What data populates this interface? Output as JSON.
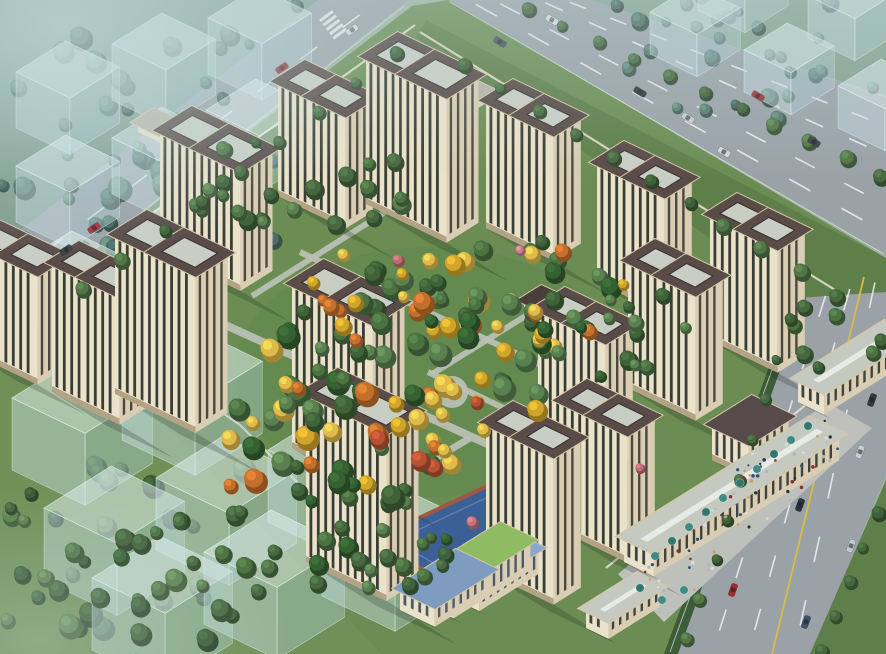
{
  "scene_label": "aerial-residential-masterplan-render",
  "projection": {
    "EU": [
      0.8,
      -0.5
    ],
    "EV": [
      0.87,
      0.42
    ],
    "twin_offset": 0.85
  },
  "colors": {
    "base": "#9db3a0",
    "zoneTL": "#7e9c8c",
    "zoneTR": "#85a28f",
    "siteGrass": "#6b8d53",
    "gardenGrass": "#648a4f",
    "fieldGrass": "#6f9157",
    "asphalt": "#9aa2a8",
    "laneWhite": "#eef1f2",
    "laneYellow": "#d9bc40",
    "edgeLine": "#dfe3e4",
    "verge": "#5f7f4a",
    "hedge": "#3d5c38",
    "pavement": "#bdc0bb",
    "path": "#bcc1b7",
    "facade": "#eae2ca",
    "facadeSide": "#d9ceb3",
    "stripSW": "#3a3d34",
    "stripSE": "#4c483d",
    "baseBand": "#b3a384",
    "roofDark": "#594b48",
    "roofPanel": "#c9cec5",
    "panelEdge": "#37322d",
    "parapet": "#d3c6a6",
    "cubeTop": "rgba(224,239,241,0.55)",
    "cubeSW": "rgba(198,223,227,0.46)",
    "cubeSE": "rgba(178,207,213,0.40)",
    "cubeEdge": "rgba(244,252,252,0.55)",
    "kgRoof": "#7d9cc0",
    "kgRoof2": "#89a8c9",
    "lawn": "#8fbc62",
    "playBlue": "#3c5f95",
    "playInner": "#5b7fb4",
    "track": "#a05844",
    "star": "#e9cb4e",
    "comRoof": "#c6c9c0",
    "comSky": "#e8eae6",
    "awning": "#3d8b82",
    "awning2": "#2f776f",
    "wall": "#e4ddc8",
    "shadow": "rgba(22,32,26,0.22)",
    "hazeTL": "rgba(198,222,225,0.60)",
    "hazeTop": "rgba(192,216,219,0.32)",
    "hazeBL": "rgba(186,210,204,0.34)"
  },
  "palettes": {
    "gardenMix": [
      "#3f6239",
      "#4c7242",
      "#5a8050",
      "#356031",
      "#4c7242",
      "#d1a52c",
      "#5a8050",
      "#e0ba4a",
      "#3f6239",
      "#c4702d"
    ],
    "gardenGreens": [
      "#3f6239",
      "#4c7242",
      "#5a8050",
      "#356031",
      "#47683f"
    ],
    "mutedTL": [
      "#4d6e63",
      "#577a6c",
      "#43635a",
      "#5e8272"
    ],
    "fieldBL": [
      "#42633c",
      "#507347",
      "#3a5a36",
      "#5d8150"
    ],
    "roadRow": [
      "#47683f",
      "#527547",
      "#3e5f38"
    ],
    "yellowAccent": [
      "#d1a52c",
      "#e0ba4a",
      "#c4702d",
      "#b55233"
    ],
    "people": [
      "#2c3136",
      "#863030",
      "#d8dade",
      "#36507a",
      "#b0b6ba",
      "#caa06a"
    ]
  },
  "zones": {
    "topLeft": [
      [
        0,
        0
      ],
      [
        322,
        0
      ],
      [
        0,
        250
      ]
    ],
    "topRight": [
      [
        590,
        0
      ],
      [
        886,
        0
      ],
      [
        886,
        96
      ]
    ],
    "site": [
      [
        412,
        6
      ],
      [
        448,
        0
      ],
      [
        886,
        258
      ],
      [
        886,
        300
      ],
      [
        806,
        654
      ],
      [
        380,
        654
      ],
      [
        40,
        292
      ]
    ],
    "field": [
      [
        0,
        250
      ],
      [
        0,
        654
      ],
      [
        380,
        654
      ],
      [
        40,
        292
      ]
    ],
    "gardenTint": {
      "cx": 430,
      "cy": 372,
      "rx": 195,
      "ry": 125
    }
  },
  "roads": {
    "highway": [
      [
        448,
        0
      ],
      [
        590,
        0
      ],
      [
        886,
        98
      ],
      [
        886,
        255
      ]
    ],
    "left": [
      [
        318,
        0
      ],
      [
        408,
        0
      ],
      [
        45,
        288
      ],
      [
        0,
        288
      ],
      [
        0,
        246
      ]
    ],
    "right": [
      [
        886,
        255
      ],
      [
        886,
        475
      ],
      [
        812,
        654
      ],
      [
        668,
        654
      ],
      [
        800,
        295
      ]
    ],
    "neVerge": [
      [
        426,
        20
      ],
      [
        886,
        258
      ],
      [
        886,
        292
      ],
      [
        798,
        298
      ],
      [
        416,
        38
      ]
    ],
    "rightHedge": [
      [
        796,
        293
      ],
      [
        664,
        654
      ],
      [
        678,
        654
      ],
      [
        806,
        298
      ]
    ],
    "rightFarVerge": [
      [
        886,
        480
      ],
      [
        886,
        654
      ],
      [
        810,
        654
      ]
    ],
    "dashes": [
      {
        "p1": [
          564,
          0
        ],
        "p2": [
          886,
          126
        ],
        "n": 8
      },
      {
        "p1": [
          539,
          0
        ],
        "p2": [
          886,
          155
        ],
        "n": 8
      },
      {
        "p1": [
          493,
          0
        ],
        "p2": [
          886,
          205
        ],
        "n": 8
      },
      {
        "p1": [
          468,
          0
        ],
        "p2": [
          886,
          233
        ],
        "n": 8
      },
      {
        "p1": [
          828,
          288
        ],
        "p2": [
          712,
          654
        ],
        "n": 7
      },
      {
        "p1": [
          852,
          281
        ],
        "p2": [
          748,
          654
        ],
        "n": 7
      },
      {
        "p1": [
          877,
          273
        ],
        "p2": [
          794,
          654
        ],
        "n": 6
      },
      {
        "p1": [
          366,
          10
        ],
        "p2": [
          26,
          266
        ],
        "n": 8
      }
    ],
    "solidWhite": [
      {
        "p1": [
          450,
          2
        ],
        "p2": [
          884,
          254
        ]
      },
      {
        "p1": [
          798,
          298
        ],
        "p2": [
          670,
          652
        ]
      },
      {
        "p1": [
          404,
          6
        ],
        "p2": [
          48,
          286
        ]
      }
    ],
    "yellowLine": {
      "p1": [
        864,
        277
      ],
      "p2": [
        772,
        654
      ]
    },
    "zebra": {
      "cx": 334,
      "cy": 26,
      "rot": -37,
      "bars": 5
    }
  },
  "walls": [
    {
      "pts": [
        [
          415,
          25
        ],
        [
          45,
          290
        ]
      ]
    },
    {
      "pts": [
        [
          45,
          290
        ],
        [
          240,
          425
        ],
        [
          430,
          615
        ]
      ]
    },
    {
      "pts": [
        [
          420,
          32
        ],
        [
          848,
          298
        ]
      ]
    },
    {
      "pts": [
        [
          606,
          568
        ],
        [
          846,
          372
        ]
      ]
    }
  ],
  "paths": [
    {
      "p1": [
        210,
        318
      ],
      "p2": [
        505,
        452
      ],
      "w": 8
    },
    {
      "p1": [
        300,
        252
      ],
      "p2": [
        556,
        372
      ],
      "w": 6
    },
    {
      "p1": [
        385,
        212
      ],
      "p2": [
        252,
        296
      ],
      "w": 6
    },
    {
      "p1": [
        548,
        302
      ],
      "p2": [
        432,
        374
      ],
      "w": 6
    },
    {
      "p1": [
        470,
        438
      ],
      "p2": [
        352,
        508
      ],
      "w": 7
    },
    {
      "p1": [
        428,
        372
      ],
      "p2": [
        512,
        412
      ],
      "w": 6
    }
  ],
  "plazaCircles": [
    {
      "x": 452,
      "y": 392,
      "r": 16
    },
    {
      "x": 370,
      "y": 300,
      "r": 9
    }
  ],
  "plaza": [
    [
      618,
      574
    ],
    [
      826,
      402
    ],
    [
      872,
      428
    ],
    [
      664,
      622
    ]
  ],
  "playground": {
    "quad": [
      [
        372,
        540
      ],
      [
        560,
        452
      ],
      [
        648,
        500
      ],
      [
        462,
        592
      ]
    ],
    "star": {
      "x": 535,
      "y": 545,
      "r": 13,
      "rot": -18
    }
  },
  "towers": [
    {
      "x": 278,
      "y": 196,
      "h": 115,
      "s": "M"
    },
    {
      "x": 366,
      "y": 204,
      "h": 148,
      "s": "L"
    },
    {
      "x": 160,
      "y": 252,
      "h": 122,
      "s": "L"
    },
    {
      "x": 486,
      "y": 228,
      "h": 128,
      "s": "M"
    },
    {
      "x": 597,
      "y": 282,
      "h": 120,
      "s": "M"
    },
    {
      "x": 710,
      "y": 340,
      "h": 126,
      "s": "M"
    },
    {
      "x": -30,
      "y": 352,
      "h": 112,
      "s": "M"
    },
    {
      "x": 52,
      "y": 392,
      "h": 130,
      "s": "M"
    },
    {
      "x": 628,
      "y": 388,
      "h": 128,
      "s": "M"
    },
    {
      "x": 115,
      "y": 394,
      "h": 160,
      "s": "L"
    },
    {
      "x": 538,
      "y": 440,
      "h": 132,
      "s": "M"
    },
    {
      "x": 292,
      "y": 448,
      "h": 165,
      "s": "L"
    },
    {
      "x": 560,
      "y": 530,
      "h": 130,
      "s": "M"
    },
    {
      "x": 486,
      "y": 572,
      "h": 150,
      "s": "M"
    },
    {
      "x": 306,
      "y": 562,
      "h": 170,
      "s": "L"
    }
  ],
  "sizes": {
    "L": {
      "du": 40,
      "dv": 50
    },
    "M": {
      "du": 34,
      "dv": 42
    }
  },
  "structures": [
    {
      "name": "kindergarten-block-a",
      "x": 400,
      "y": 610,
      "du": 70,
      "dv": 40,
      "h": 22,
      "roof": "kgRoof",
      "win": "#4f5a66"
    },
    {
      "name": "kindergarten-block-b",
      "x": 448,
      "y": 596,
      "du": 74,
      "dv": 36,
      "h": 26,
      "roof": "kgRoof2",
      "win": "#4f5a66"
    },
    {
      "name": "kindergarten-roof-lawn",
      "x": 424,
      "y": 604,
      "du": 96,
      "dv": 34,
      "h": 30,
      "roof": "lawn",
      "win": "#4f5a66"
    },
    {
      "name": "kindergarten-block-top",
      "x": 472,
      "y": 560,
      "du": 60,
      "dv": 26,
      "h": 16,
      "roof": "kgRoof",
      "win": "#4f5a66"
    },
    {
      "name": "retail-strip-south",
      "x": 586,
      "y": 628,
      "du": 64,
      "dv": 26,
      "h": 20,
      "roof": "comRoof",
      "win": "#3f443f",
      "sky": true
    },
    {
      "name": "retail-strip-main",
      "x": 624,
      "y": 562,
      "du": 232,
      "dv": 34,
      "h": 26,
      "roof": "comRoof",
      "win": "#3f443f",
      "sky": true
    },
    {
      "name": "retail-strip-north",
      "x": 798,
      "y": 402,
      "du": 108,
      "dv": 30,
      "h": 24,
      "roof": "comRoof",
      "win": "#3f443f",
      "sky": true
    },
    {
      "name": "entrance-gate",
      "x": 712,
      "y": 460,
      "du": 50,
      "dv": 42,
      "h": 36,
      "roof": "#574a4b",
      "win": "#3f443f"
    },
    {
      "name": "garden-pergola",
      "x": 524,
      "y": 308,
      "du": 22,
      "dv": 12,
      "h": 8,
      "roof": "#4a3e3b"
    },
    {
      "name": "north-entrance",
      "x": 442,
      "y": 98,
      "du": 22,
      "dv": 34,
      "h": 11,
      "roof": "#b9b3a6"
    },
    {
      "name": "west-garage",
      "x": 138,
      "y": 132,
      "du": 20,
      "dv": 26,
      "h": 10,
      "roof": "#b9b3a6"
    }
  ],
  "cubes": [
    {
      "x": 16,
      "y": 128,
      "s": 62,
      "h": 56
    },
    {
      "x": 112,
      "y": 100,
      "s": 62,
      "h": 56
    },
    {
      "x": 208,
      "y": 74,
      "s": 62,
      "h": 56
    },
    {
      "x": 16,
      "y": 222,
      "s": 62,
      "h": 56
    },
    {
      "x": 112,
      "y": 194,
      "s": 62,
      "h": 56
    },
    {
      "x": 206,
      "y": 166,
      "s": 62,
      "h": 56
    },
    {
      "x": 22,
      "y": 318,
      "s": 62,
      "h": 56
    },
    {
      "x": 118,
      "y": 290,
      "s": 62,
      "h": 56
    },
    {
      "x": 650,
      "y": 54,
      "s": 54,
      "h": 42
    },
    {
      "x": 744,
      "y": 92,
      "s": 54,
      "h": 42
    },
    {
      "x": 838,
      "y": 128,
      "s": 54,
      "h": 42
    },
    {
      "x": 808,
      "y": 38,
      "s": 54,
      "h": 42
    },
    {
      "x": 698,
      "y": 10,
      "s": 54,
      "h": 42
    },
    {
      "x": 12,
      "y": 470,
      "s": 84,
      "h": 72
    },
    {
      "x": 122,
      "y": 440,
      "s": 84,
      "h": 72
    },
    {
      "x": 44,
      "y": 580,
      "s": 84,
      "h": 72
    },
    {
      "x": 156,
      "y": 550,
      "s": 84,
      "h": 72
    },
    {
      "x": 268,
      "y": 522,
      "s": 84,
      "h": 72
    },
    {
      "x": 92,
      "y": 650,
      "s": 84,
      "h": 72
    },
    {
      "x": 204,
      "y": 624,
      "s": 84,
      "h": 72
    },
    {
      "x": 322,
      "y": 596,
      "s": 84,
      "h": 72
    }
  ],
  "clusters": [
    {
      "cx": 140,
      "cy": 150,
      "rx": 190,
      "ry": 140,
      "n": 48,
      "r0": 6,
      "r1": 12,
      "pal": "mutedTL",
      "seed": 11,
      "layer": "back"
    },
    {
      "cx": 760,
      "cy": 55,
      "rx": 140,
      "ry": 70,
      "n": 22,
      "r0": 5,
      "r1": 9,
      "pal": "mutedTL",
      "seed": 12,
      "layer": "back"
    },
    {
      "cx": 150,
      "cy": 545,
      "rx": 170,
      "ry": 100,
      "n": 26,
      "r0": 6,
      "r1": 12,
      "pal": "fieldBL",
      "seed": 13,
      "layer": "fieldA"
    },
    {
      "cx": 180,
      "cy": 600,
      "rx": 200,
      "ry": 70,
      "n": 16,
      "r0": 6,
      "r1": 12,
      "pal": "fieldBL",
      "seed": 14,
      "layer": "fieldB"
    },
    {
      "cx": 420,
      "cy": 352,
      "rx": 150,
      "ry": 92,
      "n": 55,
      "r0": 6,
      "r1": 12,
      "pal": "gardenMix",
      "seed": 15,
      "layer": "garden"
    },
    {
      "cx": 330,
      "cy": 445,
      "rx": 120,
      "ry": 75,
      "n": 36,
      "r0": 6,
      "r1": 12,
      "pal": "gardenMix",
      "seed": 16,
      "layer": "garden"
    },
    {
      "cx": 520,
      "cy": 298,
      "rx": 105,
      "ry": 62,
      "n": 26,
      "r0": 6,
      "r1": 11,
      "pal": "gardenMix",
      "seed": 17,
      "layer": "garden"
    },
    {
      "cx": 295,
      "cy": 185,
      "rx": 120,
      "ry": 48,
      "n": 22,
      "r0": 5,
      "r1": 10,
      "pal": "gardenGreens",
      "seed": 18,
      "layer": "garden"
    },
    {
      "cx": 610,
      "cy": 330,
      "rx": 85,
      "ry": 55,
      "n": 16,
      "r0": 5,
      "r1": 10,
      "pal": "gardenMix",
      "seed": 19,
      "layer": "garden"
    },
    {
      "cx": 255,
      "cy": 555,
      "rx": 140,
      "ry": 65,
      "n": 24,
      "r0": 6,
      "r1": 11,
      "pal": "gardenGreens",
      "seed": 20,
      "layer": "garden"
    },
    {
      "cx": 455,
      "cy": 420,
      "rx": 95,
      "ry": 55,
      "n": 12,
      "r0": 6,
      "r1": 10,
      "pal": "yellowAccent",
      "seed": 21,
      "layer": "garden"
    },
    {
      "cx": 380,
      "cy": 300,
      "rx": 90,
      "ry": 50,
      "n": 8,
      "r0": 5,
      "r1": 9,
      "pal": "yellowAccent",
      "seed": 22,
      "layer": "garden"
    },
    {
      "cx": 408,
      "cy": 556,
      "rx": 55,
      "ry": 32,
      "n": 10,
      "r0": 5,
      "r1": 9,
      "pal": "gardenGreens",
      "seed": 23,
      "layer": "garden"
    },
    {
      "cx": 835,
      "cy": 330,
      "rx": 50,
      "ry": 40,
      "n": 8,
      "r0": 5,
      "r1": 9,
      "pal": "gardenGreens",
      "seed": 24,
      "layer": "garden"
    }
  ],
  "rows": [
    {
      "p1": [
        530,
        8
      ],
      "p2": [
        880,
        176
      ],
      "n": 11,
      "r": 7,
      "pal": "roadRow"
    },
    {
      "p1": [
        466,
        64
      ],
      "p2": [
        836,
        296
      ],
      "n": 11,
      "r": 7,
      "pal": "roadRow"
    },
    {
      "p1": [
        618,
        4
      ],
      "p2": [
        872,
        86
      ],
      "n": 6,
      "r": 6,
      "pal": "mutedTL"
    },
    {
      "p1": [
        880,
        512
      ],
      "p2": [
        822,
        650
      ],
      "n": 5,
      "r": 7,
      "pal": "roadRow"
    },
    {
      "p1": [
        398,
        52
      ],
      "p2": [
        84,
        290
      ],
      "n": 9,
      "r": 7,
      "pal": "roadRow"
    },
    {
      "p1": [
        298,
        4
      ],
      "p2": [
        22,
        236
      ],
      "n": 7,
      "r": 6,
      "pal": "mutedTL"
    },
    {
      "p1": [
        792,
        318
      ],
      "p2": [
        688,
        640
      ],
      "n": 9,
      "r": 6,
      "pal": "roadRow"
    }
  ],
  "pinkTrees": [
    {
      "x": 398,
      "y": 260,
      "r": 6,
      "c": "#bd6b75"
    },
    {
      "x": 472,
      "y": 522,
      "r": 6,
      "c": "#c4737f"
    },
    {
      "x": 640,
      "y": 468,
      "r": 5,
      "c": "#bd6b75"
    },
    {
      "x": 520,
      "y": 250,
      "r": 5,
      "c": "#c97f8e"
    }
  ],
  "cars": [
    {
      "x": 500,
      "y": 42,
      "rot": 31,
      "c": "#49525a"
    },
    {
      "x": 552,
      "y": 20,
      "rot": 31,
      "c": "#d9dde0"
    },
    {
      "x": 640,
      "y": 92,
      "rot": 31,
      "c": "#2e343a"
    },
    {
      "x": 688,
      "y": 118,
      "rot": 31,
      "c": "#c9cdd1"
    },
    {
      "x": 758,
      "y": 96,
      "rot": 31,
      "c": "#a03231"
    },
    {
      "x": 814,
      "y": 142,
      "rot": 31,
      "c": "#3a4147"
    },
    {
      "x": 724,
      "y": 152,
      "rot": 31,
      "c": "#d2d6d9"
    },
    {
      "x": 94,
      "y": 228,
      "rot": 146,
      "c": "#a83238"
    },
    {
      "x": 66,
      "y": 250,
      "rot": 146,
      "c": "#3c4248"
    },
    {
      "x": 282,
      "y": 68,
      "rot": 146,
      "c": "#9e2f34"
    },
    {
      "x": 352,
      "y": 30,
      "rot": 146,
      "c": "#d5d9db"
    },
    {
      "x": 800,
      "y": 505,
      "rot": 110,
      "c": "#2c3238"
    },
    {
      "x": 733,
      "y": 590,
      "rot": 110,
      "c": "#a02c2c"
    },
    {
      "x": 806,
      "y": 622,
      "rot": 110,
      "c": "#3c516e"
    },
    {
      "x": 860,
      "y": 452,
      "rot": 110,
      "c": "#c9ced2"
    },
    {
      "x": 872,
      "y": 400,
      "rot": 110,
      "c": "#343a40"
    },
    {
      "x": 851,
      "y": 546,
      "rot": 110,
      "c": "#c4c9cd"
    }
  ],
  "peopleBands": [
    {
      "p1": [
        660,
        592
      ],
      "p2": [
        832,
        424
      ],
      "halfW": 26,
      "n": 60,
      "seed": 31
    },
    {
      "p1": [
        735,
        480
      ],
      "p2": [
        760,
        455
      ],
      "halfW": 12,
      "n": 10,
      "seed": 32
    }
  ],
  "umbrellas": [
    [
      655,
      556
    ],
    [
      672,
      541
    ],
    [
      689,
      527
    ],
    [
      706,
      512
    ],
    [
      723,
      498
    ],
    [
      740,
      483
    ],
    [
      757,
      469
    ],
    [
      774,
      454
    ],
    [
      791,
      440
    ],
    [
      808,
      426
    ],
    [
      662,
      600
    ],
    [
      640,
      588
    ],
    [
      684,
      590
    ]
  ]
}
